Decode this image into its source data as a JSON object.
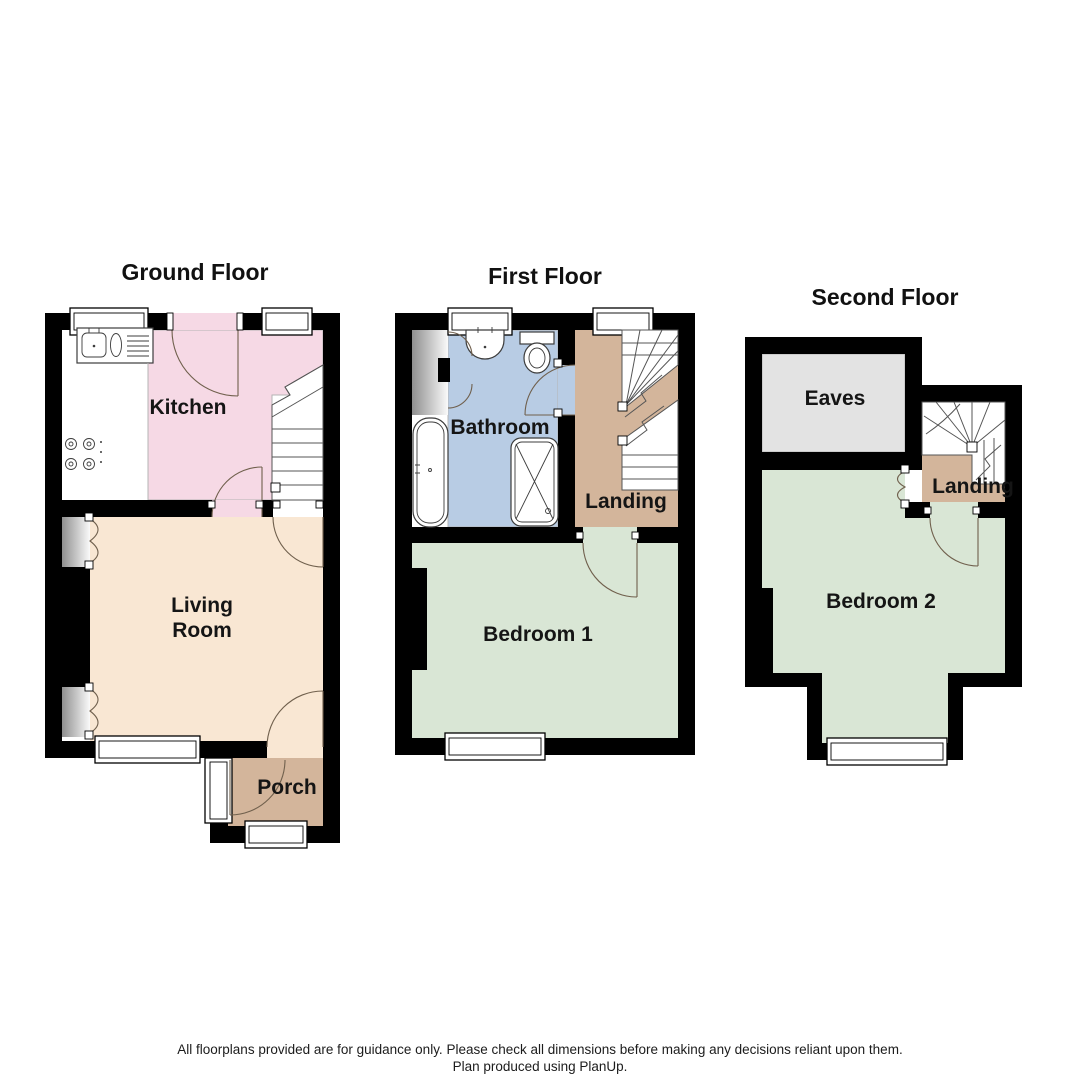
{
  "ground": {
    "title": "Ground Floor",
    "kitchen": "Kitchen",
    "living_line1": "Living",
    "living_line2": "Room",
    "porch": "Porch"
  },
  "first": {
    "title": "First Floor",
    "bathroom": "Bathroom",
    "landing": "Landing",
    "bedroom": "Bedroom 1"
  },
  "second": {
    "title": "Second Floor",
    "eaves": "Eaves",
    "landing": "Landing",
    "bedroom": "Bedroom 2"
  },
  "footer": {
    "line1": "All floorplans provided are for guidance only. Please check all dimensions before making any decisions reliant upon them.",
    "line2": "Plan produced using PlanUp."
  },
  "colors": {
    "wall": "#000000",
    "kitchen": "#f6d9e5",
    "living": "#f9e7d3",
    "porch": "#d3b59b",
    "bathroom": "#b8cce4",
    "bedroom": "#d9e6d5",
    "eaves": "#e3e3e3",
    "landing": "#d3b59b"
  }
}
